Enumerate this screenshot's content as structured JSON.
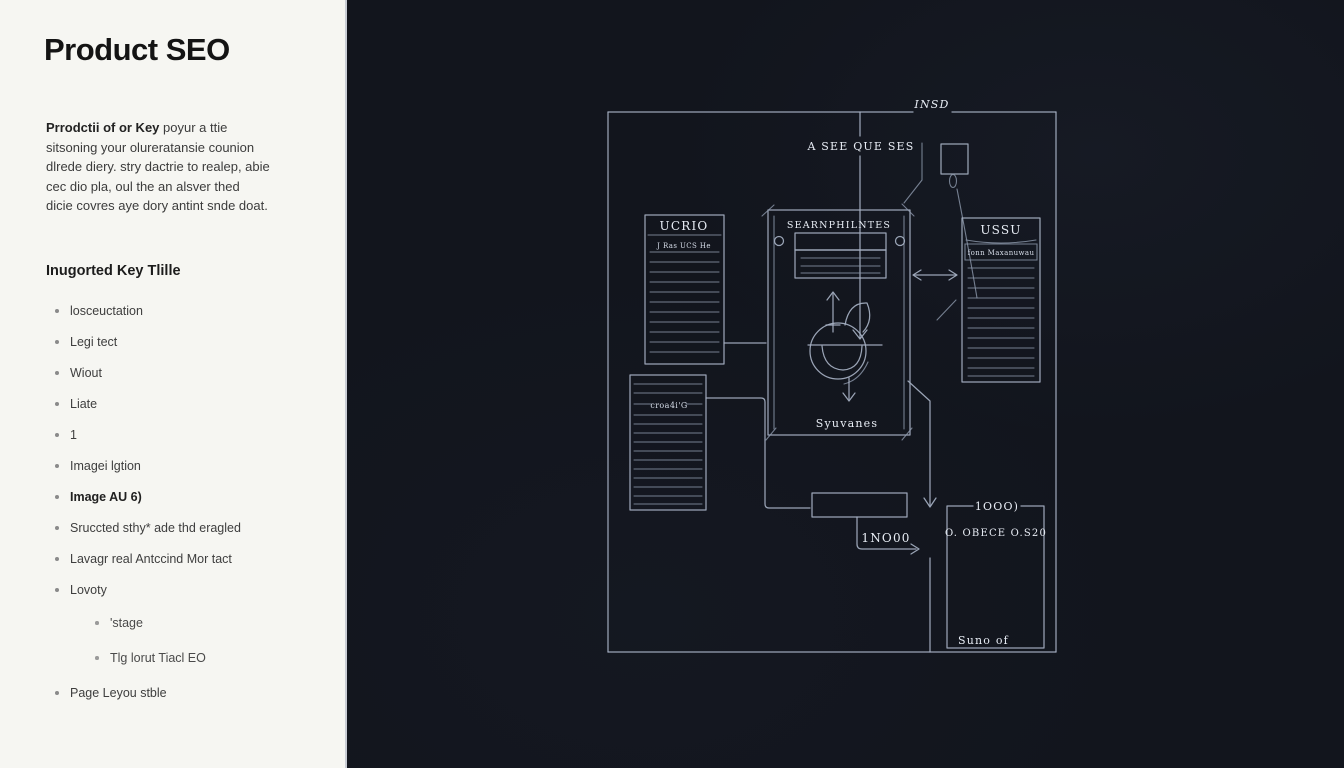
{
  "left_panel": {
    "title": "Product SEO",
    "intro": {
      "lead": "Prrodctii of or Key",
      "rest": " poyur a ttie sitsoning your olureratansie counion dlrede diery. stry dactrie to realep, abie cec dio pla, oul the an alsver thed dicie covres aye dory antint snde doat."
    },
    "section_heading": "Inugorted Key Tlille",
    "list": [
      {
        "label": "losceuctation"
      },
      {
        "label": "Legi tect"
      },
      {
        "label": "Wiout"
      },
      {
        "label": "Liate"
      },
      {
        "label": "1"
      },
      {
        "label": "Imagei lgtion"
      },
      {
        "label": "Image AU 6)"
      },
      {
        "label": "Sruccted sthy* ade thd eragled"
      },
      {
        "label": "Lavagr real Antccind Mor tact"
      },
      {
        "label": "Lovoty"
      },
      {
        "label": "'stage"
      },
      {
        "label": "Tlg lorut Tiacl EO"
      },
      {
        "label": "Page Leyou stble"
      }
    ]
  },
  "diagram": {
    "outer_label": "INSD",
    "flow_label": "A SEE QUE SES",
    "left_box": {
      "title": "UCRIO",
      "subtitle": "J Ras UCS He"
    },
    "center_box": {
      "title": "SEARNPHILNTES",
      "bottom_label": "Syuvanes"
    },
    "right_box": {
      "title": "USSU",
      "subtitle": "fonn Maxanuwau"
    },
    "lower_left_box": {
      "label": "croa4i'G"
    },
    "connector_label": "1NO00",
    "result_box": {
      "top_label": "1OOO)",
      "text": "O. OBECE O.S20",
      "bottom_label": "Suno of"
    },
    "colors": {
      "panel_background": "#f6f6f2",
      "dark_background": "#12151d",
      "line": "#a6b1c3",
      "diagram_text": "#e8edf5",
      "title_text": "#141414"
    }
  }
}
